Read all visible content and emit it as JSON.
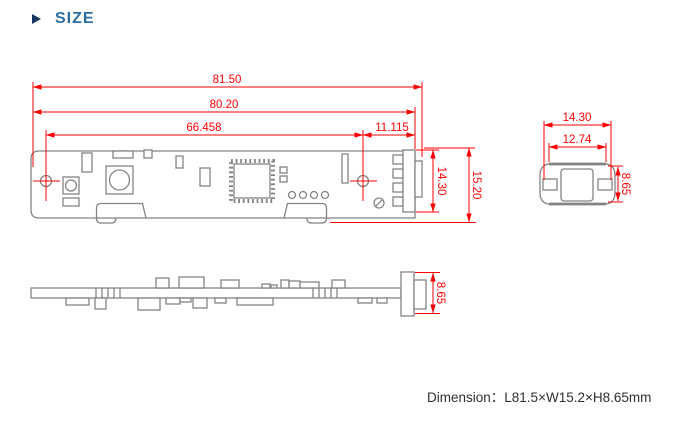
{
  "header": {
    "title": "SIZE"
  },
  "colors": {
    "dimension_red": "#ff0000",
    "drawing_gray": "#848484",
    "title_blue": "#2c6da0",
    "bullet_navy": "#17365d",
    "footer_text": "#2f2f2f"
  },
  "top_view": {
    "dims": {
      "overall_length": "81.50",
      "board_length": "80.20",
      "hole_spacing": "66.458",
      "hole_to_edge": "11.115",
      "connector_height": "14.30",
      "overall_width": "15.20"
    }
  },
  "end_view": {
    "dims": {
      "outer_width": "14.30",
      "inner_width": "12.74",
      "height": "8.65"
    }
  },
  "side_view": {
    "dims": {
      "height": "8.65"
    }
  },
  "footer": {
    "label": "Dimension：",
    "value": "L81.5×W15.2×H8.65mm"
  }
}
